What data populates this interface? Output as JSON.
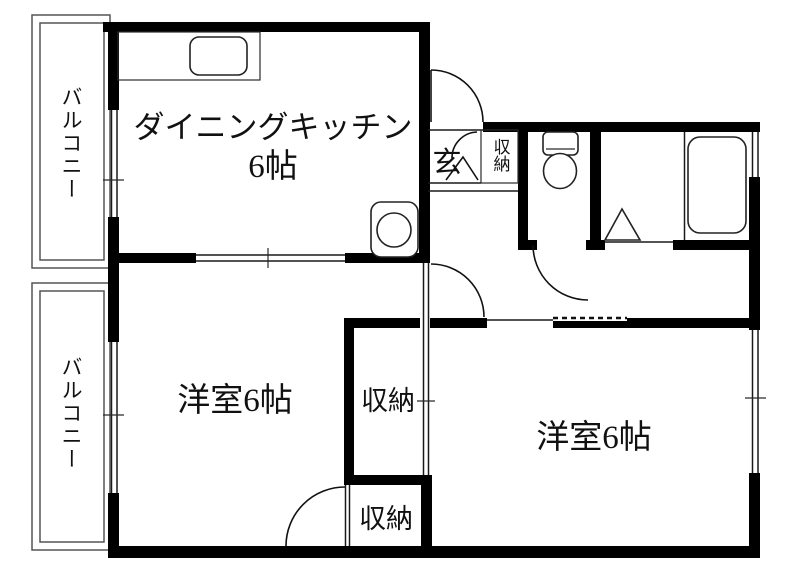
{
  "plan_type": "japanese-apartment-floor-plan",
  "labels": {
    "balcony_top": "バルコニー",
    "balcony_bottom": "バルコニー",
    "dining_kitchen": "ダイニングキッチン",
    "dining_kitchen_size": "6帖",
    "western_room_left": "洋室6帖",
    "western_room_right": "洋室6帖",
    "entrance": "玄",
    "entrance_storage": "収納",
    "storage_upper": "収納",
    "storage_lower": "収納"
  },
  "fixtures": [
    {
      "name": "kitchen-counter-sink-icon"
    },
    {
      "name": "stove-unit-icon"
    },
    {
      "name": "toilet-icon"
    },
    {
      "name": "bathtub-icon"
    },
    {
      "name": "washing-machine-triangle-icon"
    }
  ],
  "colors": {
    "wall": "#000000",
    "line": "#1a1a1a",
    "balcony_line": "#555555",
    "background": "#ffffff",
    "text": "#111111"
  }
}
